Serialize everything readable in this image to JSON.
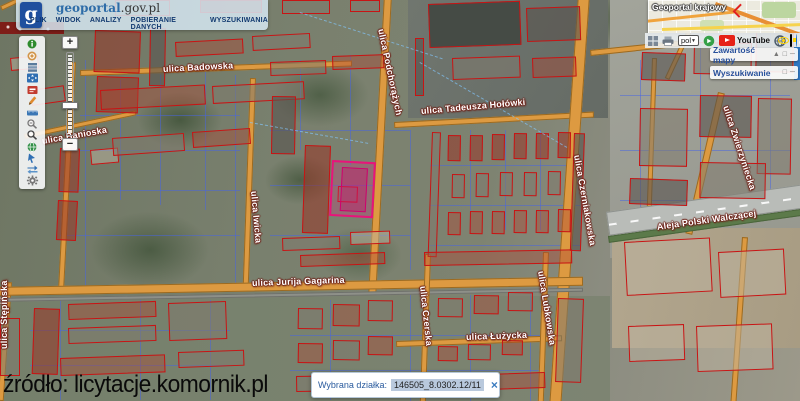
{
  "header": {
    "logo_mark": "g",
    "title_primary": "geoportal",
    "title_secondary": ".gov.pl",
    "menu": [
      "PLIK",
      "WIDOK",
      "ANALIZY",
      "POBIERANIE DANYCH",
      "WYSZUKIWANIA"
    ]
  },
  "left_toolbar": {
    "icons": [
      "info",
      "legend",
      "layers",
      "pan-view",
      "print",
      "draw",
      "measure",
      "zoom-box",
      "search-magnifier",
      "globe",
      "select-feature",
      "swap-view",
      "settings-gear"
    ]
  },
  "zoom_control": {
    "plus": "+",
    "minus": "−"
  },
  "minimap": {
    "label": "Geoportal krajowy"
  },
  "top_right_bar": {
    "language_value": "pol",
    "youtube_label": "YouTube",
    "icons": [
      "grid",
      "printer",
      "language-select",
      "refresh",
      "youtube",
      "globe",
      "contrast-eye",
      "accessibility"
    ]
  },
  "panels": {
    "map_contents": {
      "title": "Zawartość mapy",
      "icons": [
        "▲",
        "□",
        "─"
      ]
    },
    "search": {
      "title": "Wyszukiwanie",
      "icons": [
        "□",
        "─"
      ]
    }
  },
  "parcel_info": {
    "label": "Wybrana działka:",
    "value": "146505_8.0302.12/11",
    "close": "×"
  },
  "watermark": "źródło: licytacje.komornik.pl",
  "map": {
    "selected_parcel_color": "#e8147a",
    "road_color": "#dd9a41",
    "building_outline_color": "#c81414",
    "parcel_line_color": "#4664e6",
    "street_labels": [
      {
        "name": "ulica Badowska",
        "x": 163,
        "y": 64,
        "rot": -3
      },
      {
        "name": "ulica Banioska",
        "x": 42,
        "y": 136,
        "rot": -10
      },
      {
        "name": "ulica Podchorążych",
        "x": 381,
        "y": 24,
        "rot": 78
      },
      {
        "name": "ulica Tadeusza Hołówki",
        "x": 421,
        "y": 106,
        "rot": -5
      },
      {
        "name": "ulica Czerniakowska",
        "x": 577,
        "y": 150,
        "rot": 80
      },
      {
        "name": "ulica Zwierzyniecka",
        "x": 726,
        "y": 101,
        "rot": 72
      },
      {
        "name": "Aleja Polski Walczącej",
        "x": 657,
        "y": 222,
        "rot": -8
      },
      {
        "name": "ulica Jurija Gagarina",
        "x": 252,
        "y": 278,
        "rot": -2
      },
      {
        "name": "ulica Iwicka",
        "x": 254,
        "y": 186,
        "rot": 85
      },
      {
        "name": "ulica Czerska",
        "x": 423,
        "y": 281,
        "rot": 84
      },
      {
        "name": "ulica Łużycka",
        "x": 466,
        "y": 332,
        "rot": -2
      },
      {
        "name": "ulica Lubkowska",
        "x": 541,
        "y": 266,
        "rot": 81
      },
      {
        "name": "ulica Stępińska",
        "x": 4,
        "y": 344,
        "rot": -90
      }
    ]
  }
}
